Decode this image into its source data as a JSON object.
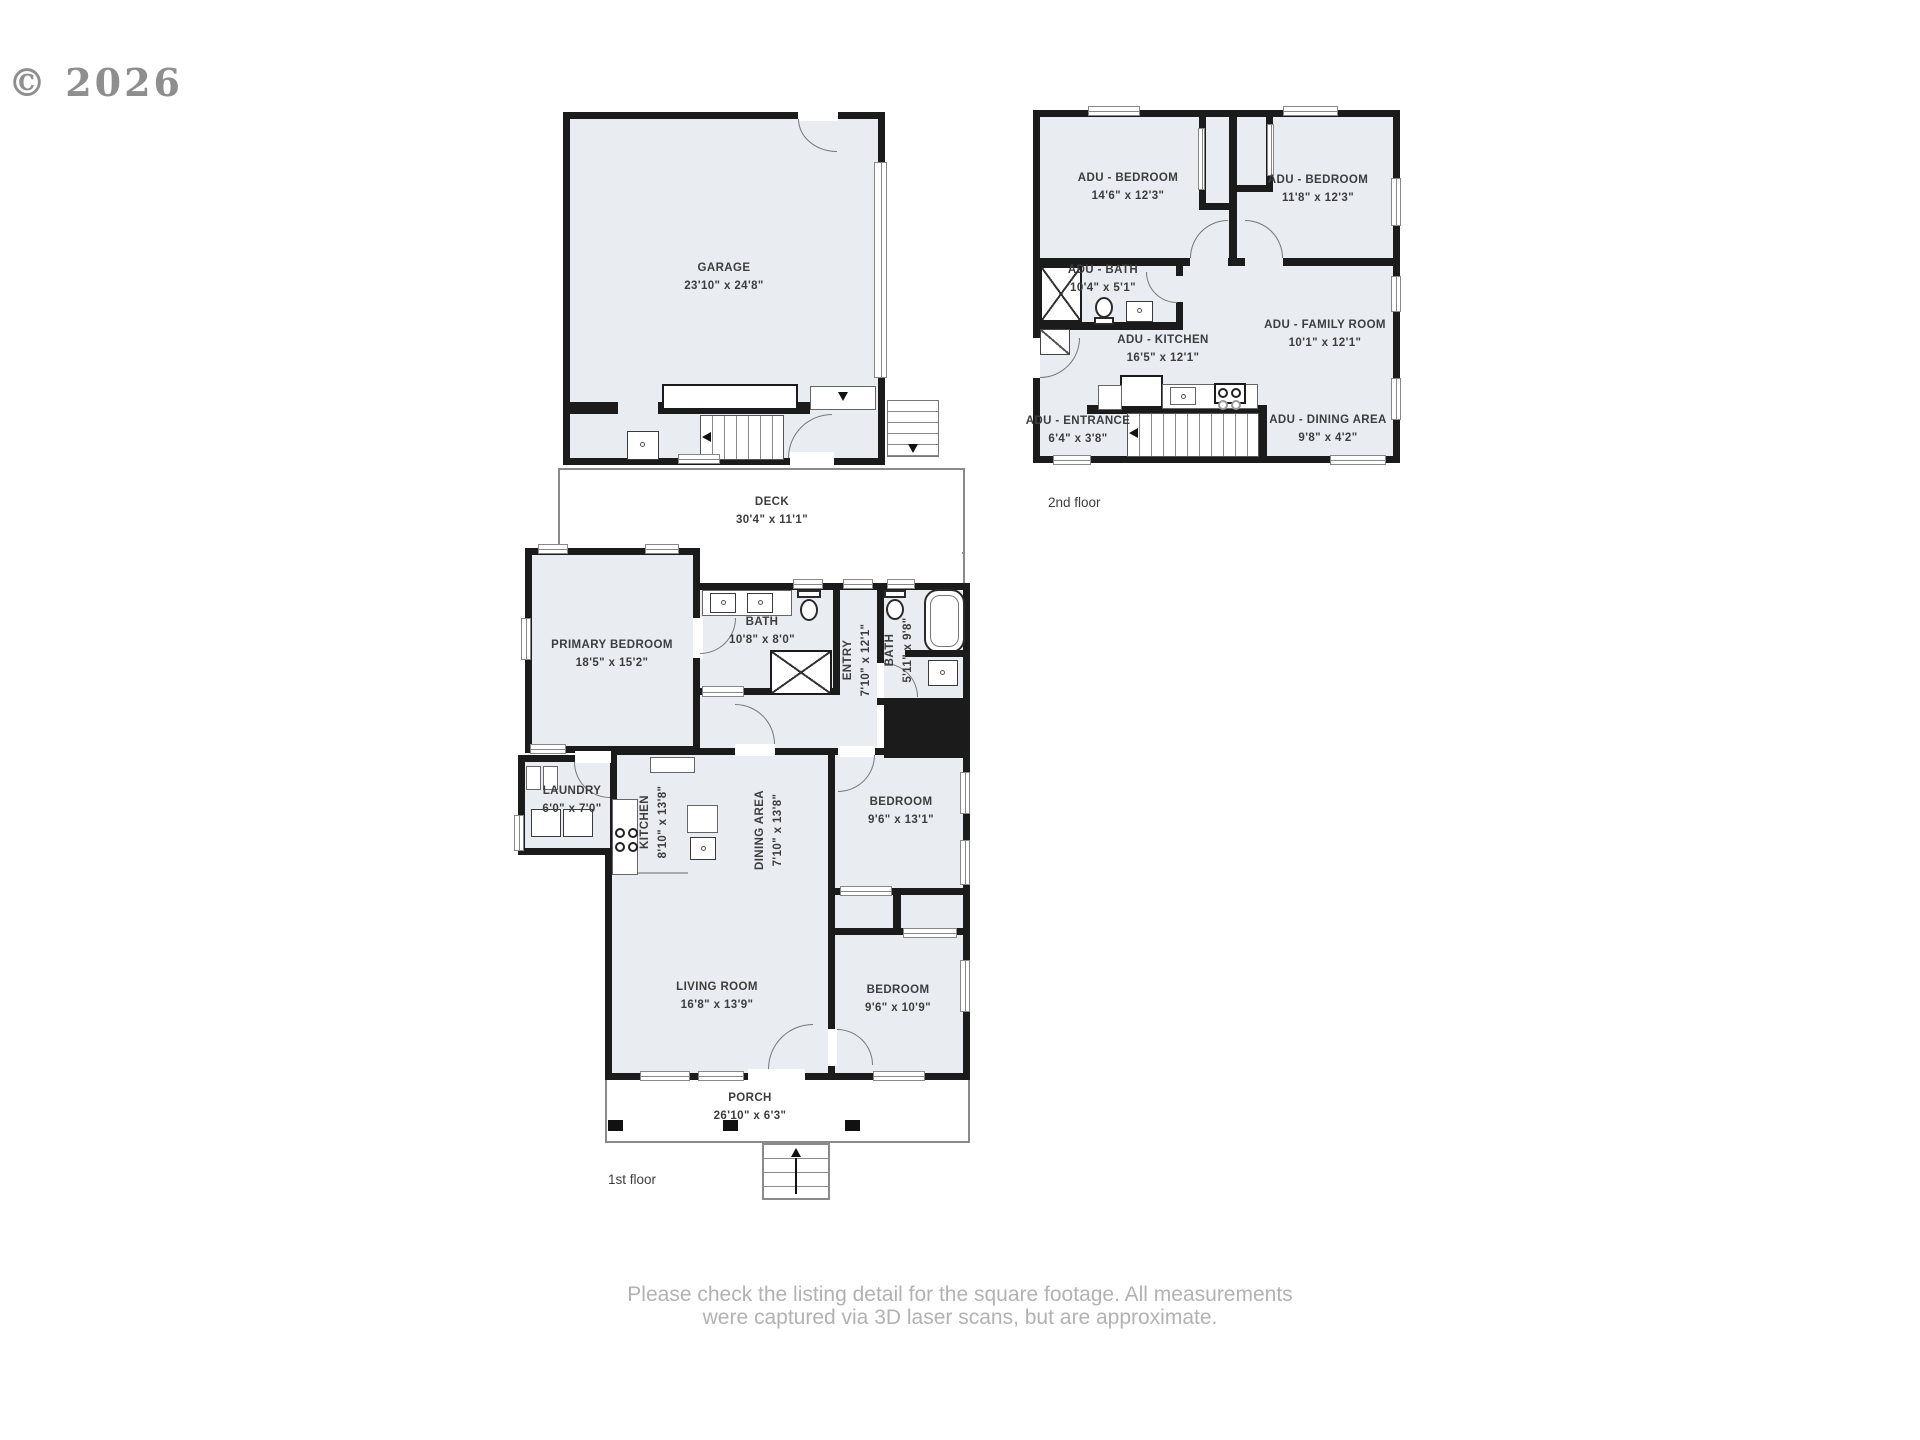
{
  "watermark": "© 2026",
  "colors": {
    "wall": "#1B1B1B",
    "room_fill": "#E9EDF1",
    "outline_gray": "#8A8A8A",
    "label_text": "#3D3D3D",
    "disclaimer_text": "#B2B2B2",
    "watermark_text": "#8E8E8E"
  },
  "floors": {
    "first": {
      "label": "1st floor",
      "rooms": {
        "garage": {
          "name": "GARAGE",
          "dims": "23'10\" x 24'8\""
        },
        "deck": {
          "name": "DECK",
          "dims": "30'4\" x 11'1\""
        },
        "primary_bedroom": {
          "name": "PRIMARY BEDROOM",
          "dims": "18'5\" x 15'2\""
        },
        "bath_main": {
          "name": "BATH",
          "dims": "10'8\" x 8'0\""
        },
        "entry": {
          "name": "ENTRY",
          "dims": "7'10\" x 12'1\""
        },
        "bath_hall": {
          "name": "BATH",
          "dims": "5'11\" x 9'8\""
        },
        "laundry": {
          "name": "LAUNDRY",
          "dims": "6'0\" x 7'0\""
        },
        "kitchen": {
          "name": "KITCHEN",
          "dims": "8'10\" x 13'8\""
        },
        "dining_area": {
          "name": "DINING AREA",
          "dims": "7'10\" x 13'8\""
        },
        "bedroom_upper": {
          "name": "BEDROOM",
          "dims": "9'6\" x 13'1\""
        },
        "living_room": {
          "name": "LIVING ROOM",
          "dims": "16'8\" x 13'9\""
        },
        "bedroom_lower": {
          "name": "BEDROOM",
          "dims": "9'6\" x 10'9\""
        },
        "porch": {
          "name": "PORCH",
          "dims": "26'10\" x 6'3\""
        }
      }
    },
    "second": {
      "label": "2nd floor",
      "rooms": {
        "adu_bedroom_left": {
          "name": "ADU - BEDROOM",
          "dims": "14'6\" x 12'3\""
        },
        "adu_bedroom_right": {
          "name": "ADU - BEDROOM",
          "dims": "11'8\" x 12'3\""
        },
        "adu_bath": {
          "name": "ADU - BATH",
          "dims": "10'4\" x 5'1\""
        },
        "adu_kitchen": {
          "name": "ADU - KITCHEN",
          "dims": "16'5\" x 12'1\""
        },
        "adu_family_room": {
          "name": "ADU - FAMILY ROOM",
          "dims": "10'1\" x 12'1\""
        },
        "adu_entrance": {
          "name": "ADU - ENTRANCE",
          "dims": "6'4\" x 3'8\""
        },
        "adu_dining_area": {
          "name": "ADU - DINING AREA",
          "dims": "9'8\" x 4'2\""
        }
      }
    }
  },
  "disclaimer": {
    "line1": "Please check the listing detail for the square footage. All measurements",
    "line2": "were captured via 3D laser scans, but are approximate."
  }
}
